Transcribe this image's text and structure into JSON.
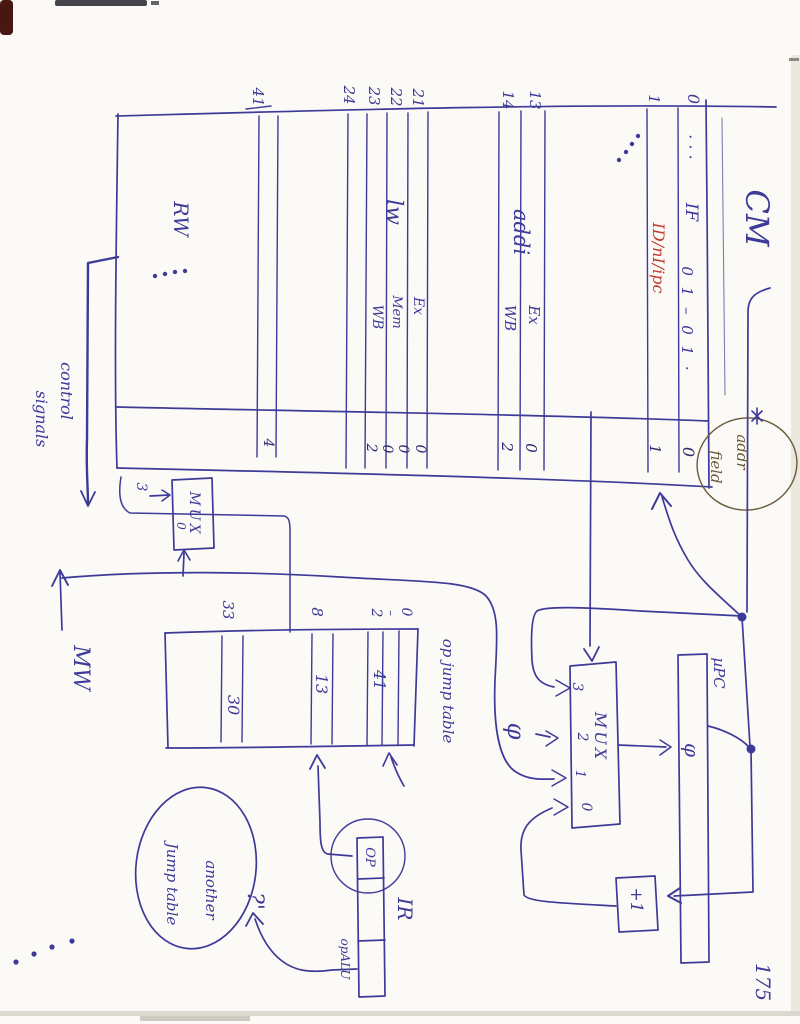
{
  "colors": {
    "ink": "#3d3a99",
    "ink_dark": "#34317f",
    "red": "#c03b2d",
    "paper": "#fbfaf6"
  },
  "page": {
    "number": "175",
    "corner_dots": "·  ·  ·  ·"
  },
  "cm": {
    "title": "CM",
    "addr_annotation": {
      "line1": "addr",
      "line2": "field"
    },
    "rows": {
      "r0": {
        "num": "0",
        "dots": "· · ·",
        "label": "IF",
        "bits": "0 1 – 0 1 ·",
        "addr": "0"
      },
      "r1": {
        "num": "1",
        "label": "ID/nI/ipc",
        "addr": "1"
      },
      "gap_dots": "· · ·",
      "addi_label": "addi",
      "r13": {
        "num": "13",
        "stage": "Ex",
        "addr": "0"
      },
      "r14": {
        "num": "14",
        "stage": "WB",
        "addr": "2"
      },
      "lw_label": "lw",
      "r21": {
        "num": "21",
        "stage": "Ex",
        "addr": "0"
      },
      "r22": {
        "num": "22",
        "stage": "Mem",
        "addr": "0"
      },
      "r23": {
        "num": "23",
        "stage": "WB",
        "addr": "0"
      },
      "r24": {
        "num": "24",
        "addr": "2"
      },
      "r41": {
        "num": "41",
        "addr": "4"
      },
      "rw_label": "RW",
      "bottom_dots": "· · · ·"
    },
    "outputs": {
      "control_line1": "control",
      "control_line2": "signals",
      "mw": "MW"
    }
  },
  "addr_mux": {
    "label": "MUX",
    "input3": "3",
    "input0": "0"
  },
  "op_jump_table": {
    "label": "op jump table",
    "index_33": "33",
    "index_8": "8",
    "index_2": "2",
    "index_dash": "–",
    "index_0": "0",
    "value_33": "30",
    "value_8": "13",
    "value_02": "41"
  },
  "note": {
    "line1": "another",
    "line2": "Jump table",
    "question": "?'"
  },
  "ir": {
    "label": "IR",
    "op_field": "OP",
    "opalu_field": "opALU"
  },
  "upc_mux": {
    "label": "MUX",
    "in3": "3",
    "in2": "2",
    "in1": "1",
    "in0": "0",
    "zero_input": "φ"
  },
  "upc": {
    "label": "µPC",
    "value": "φ"
  },
  "incrementer": {
    "label": "+1"
  }
}
